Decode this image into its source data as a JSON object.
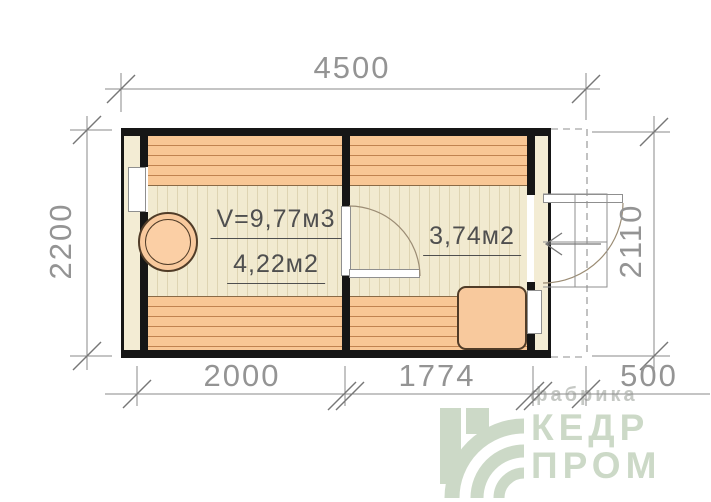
{
  "dims": {
    "top": "4500",
    "left": "2200",
    "right": "2110",
    "bottom_left": "2000",
    "bottom_center": "1774",
    "bottom_right": "500"
  },
  "rooms": {
    "steam": {
      "volume_label": "V=9,77м3",
      "area_label": "4,22м2"
    },
    "rest": {
      "area_label": "3,74м2"
    }
  },
  "fixtures": {
    "stove": "round-stove-icon",
    "table": "corner-table",
    "entry_arrow": "entrance-arrow-icon"
  },
  "logo": {
    "tagline": "фабрика",
    "name_line1": "КЕДР",
    "name_line2": "ПРОМ"
  },
  "colors": {
    "bench_orange": "#f8c795",
    "plank_line_brown": "#c08350",
    "floor_cream": "#f1ead0",
    "floor_line": "#ded4b2",
    "wall_black": "#161616",
    "wall_core_cream": "#f3ecd4",
    "fixture_fill": "#f8c99d",
    "fixture_stroke": "#503c28",
    "dimension_gray": "#949494",
    "line_gray": "#8f8f8f",
    "door_arc_brown": "#9b8c74",
    "label_gray": "#4f4f4f",
    "logo_green": "#ccd9c7",
    "logo_tagline_gray": "#c5c8c4"
  }
}
